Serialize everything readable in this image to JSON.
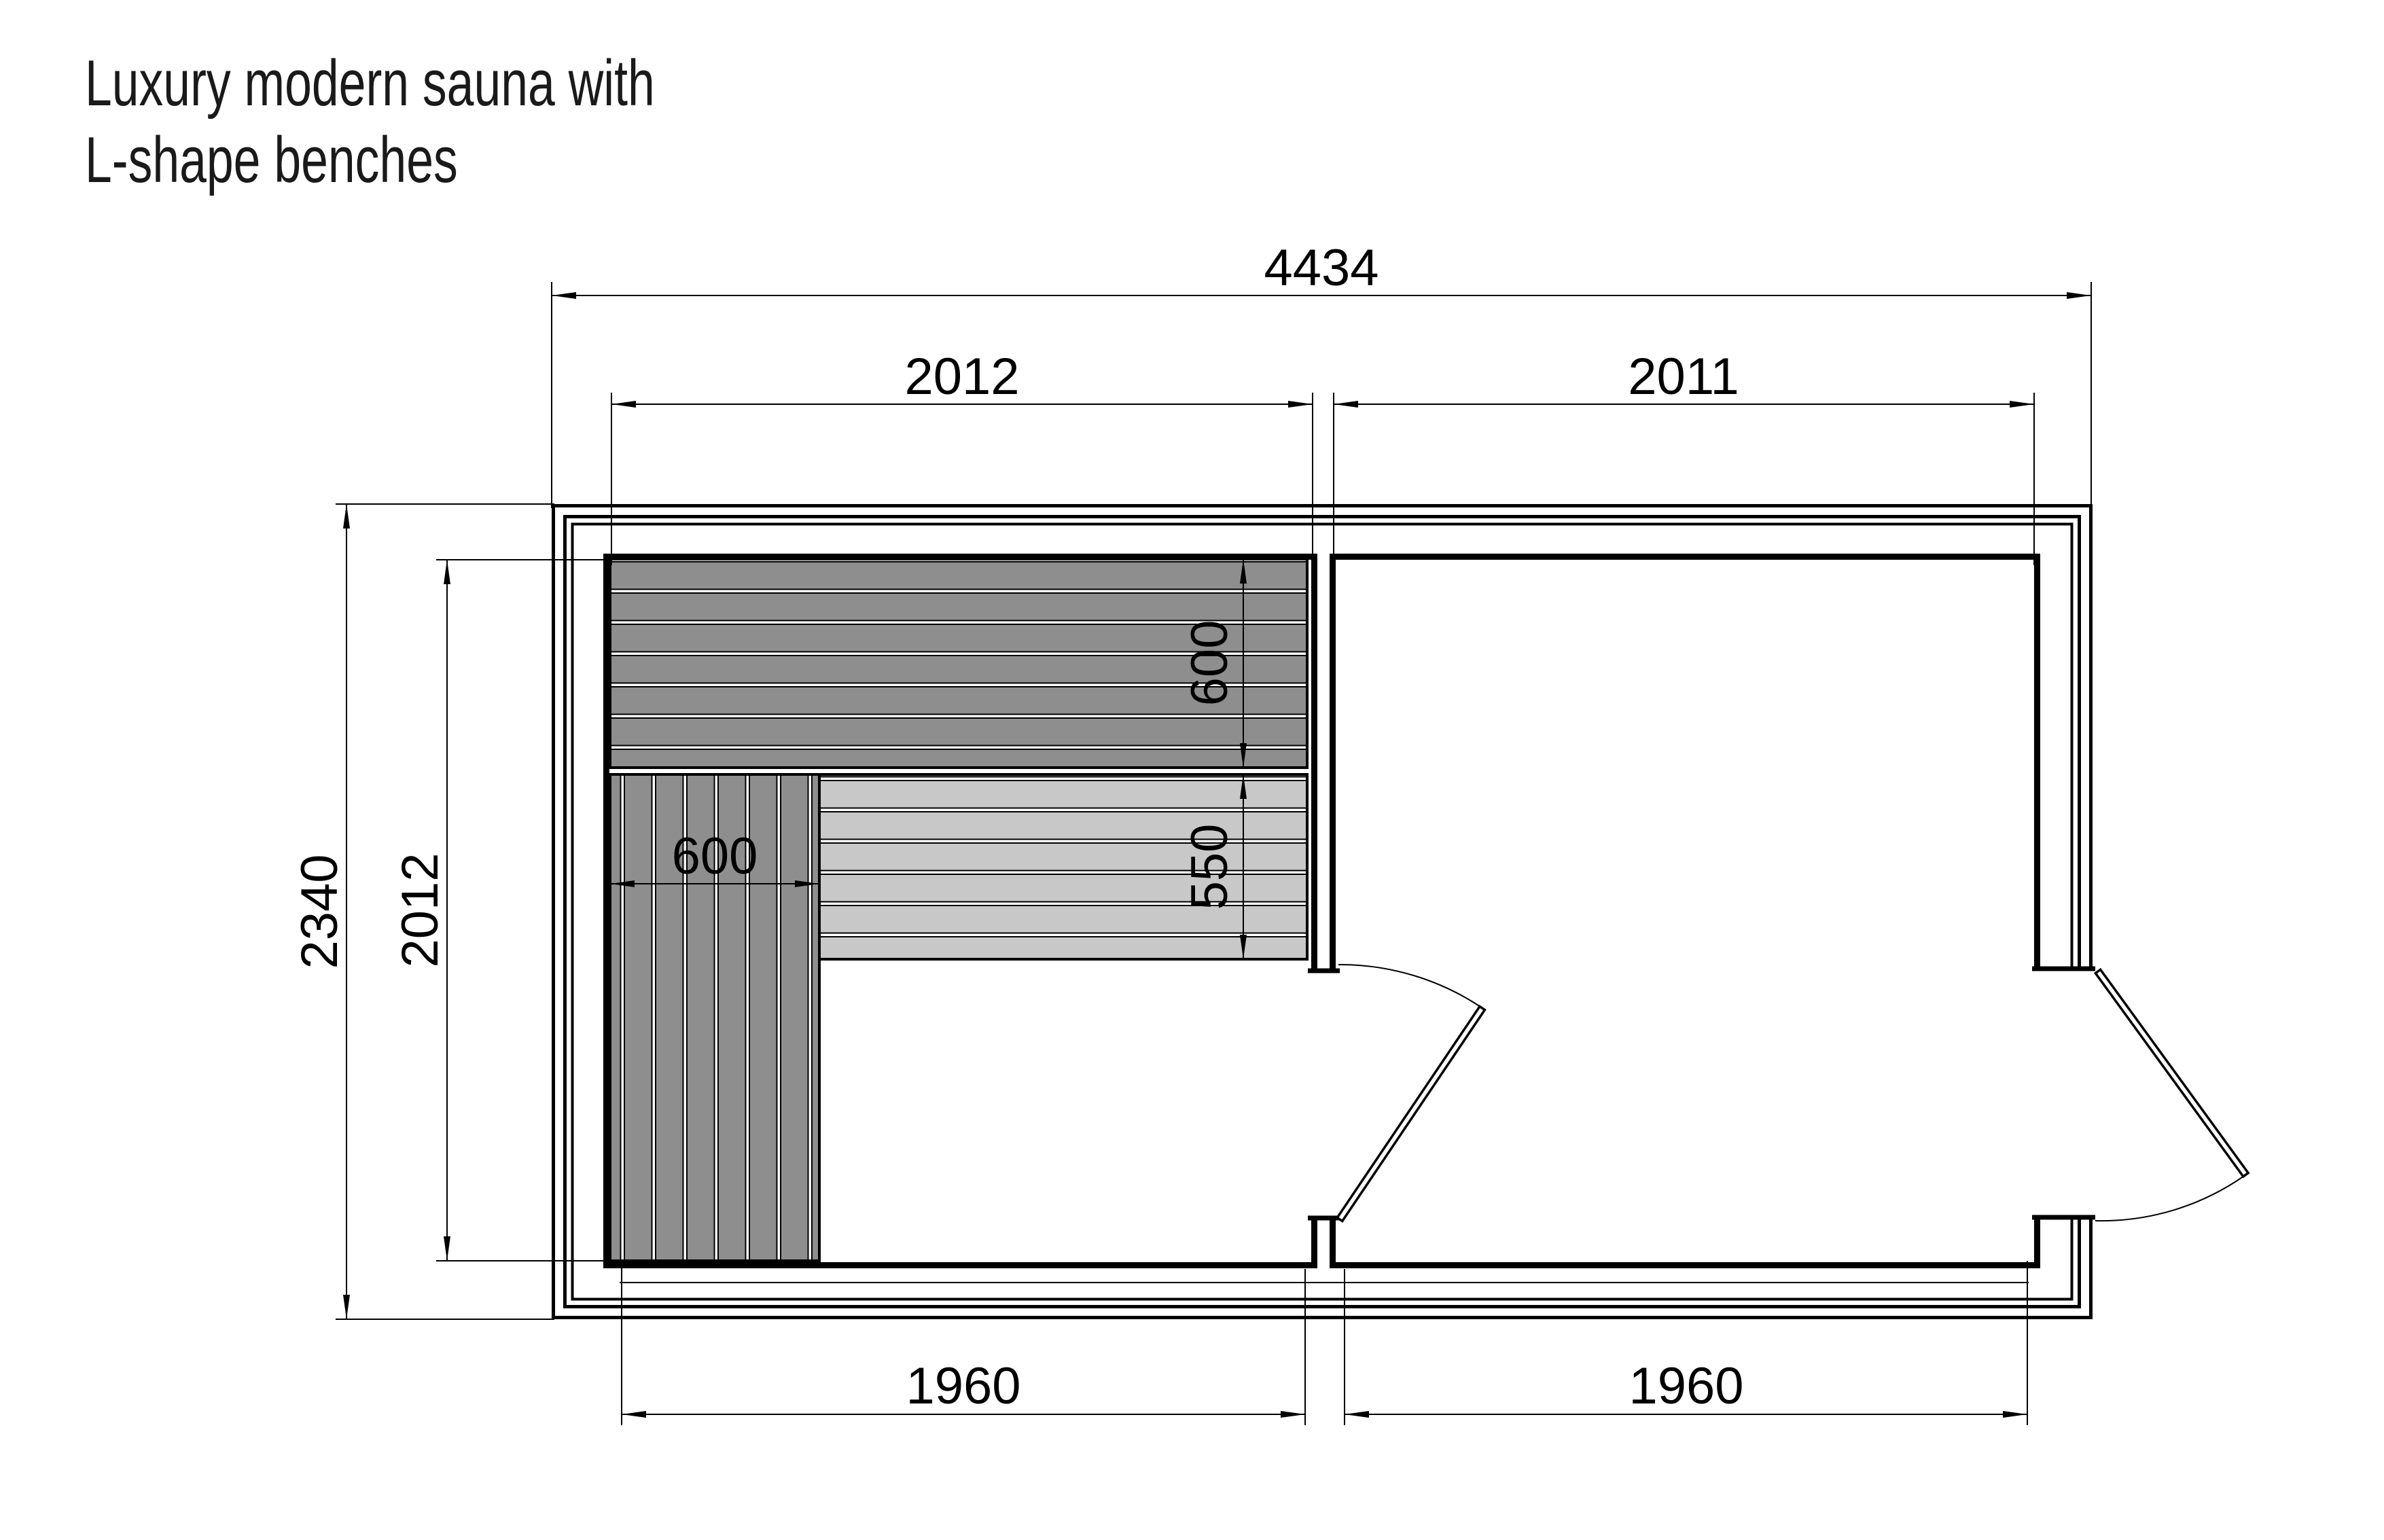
{
  "title": {
    "line1": "Luxury modern sauna with",
    "line2": "L-shape benches"
  },
  "dimensions_mm": {
    "overall_width": "4434",
    "sauna_room_width": "2012",
    "anteroom_width": "2011",
    "overall_depth": "2340",
    "sauna_room_depth": "2012",
    "upper_bench_depth": "600",
    "lower_bench_depth": "550",
    "side_bench_width": "600",
    "sauna_floor_width": "1960",
    "anteroom_floor_width": "1960"
  },
  "colors": {
    "line": "#000000",
    "ink": "#1a1a1a",
    "bench-dark": "#8E8E8E",
    "bench-light": "#C8C8C8",
    "paper": "#FFFFFF"
  }
}
